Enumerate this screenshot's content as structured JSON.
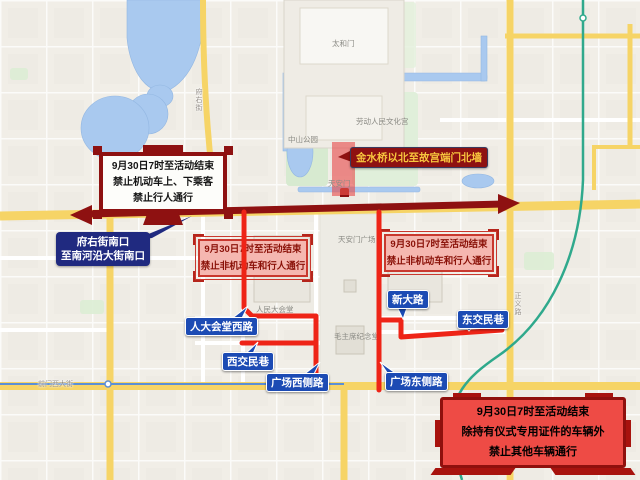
{
  "banner_west": {
    "lines": [
      "9月30日7时至活动结束",
      "禁止机动车上、下乘客",
      "禁止行人通行"
    ]
  },
  "fuyou_label": {
    "lines": [
      "府右街南口",
      "至南河沿大街南口"
    ]
  },
  "zone_label": {
    "text": "金水桥以北至故宫端门北墙"
  },
  "pink_west": {
    "lines": [
      "9月30日7时至活动结束",
      "禁止非机动车和行人通行"
    ]
  },
  "pink_east": {
    "lines": [
      "9月30日7时至活动结束",
      "禁止非机动车和行人通行"
    ]
  },
  "red_box": {
    "lines": [
      "9月30日7时至活动结束",
      "除持有仪式专用证件的车辆外",
      "禁止其他车辆通行"
    ]
  },
  "road_bubbles": [
    "人大会堂西路",
    "西交民巷",
    "广场西侧路",
    "广场东侧路",
    "新大路",
    "东交民巷"
  ],
  "map_labels": [
    "天安门广场",
    "人民大会堂",
    "毛主席纪念堂",
    "天安门",
    "中山公园",
    "劳动人民文化宫",
    "太和门"
  ],
  "road_names": [
    "西长安街",
    "前门西大街",
    "府右街",
    "正义路"
  ],
  "colors": {
    "dark_red": "#8e1111",
    "route_red": "#ee2417",
    "pink_bg": "#f5b7b0",
    "navy": "#202a80",
    "bubble_blue": "#1c4bb4",
    "highlight_zone": "#e64c4c",
    "road_yellow": "#f6d466",
    "water_blue": "#a9c9ef",
    "subway_teal": "#2fa98c"
  }
}
